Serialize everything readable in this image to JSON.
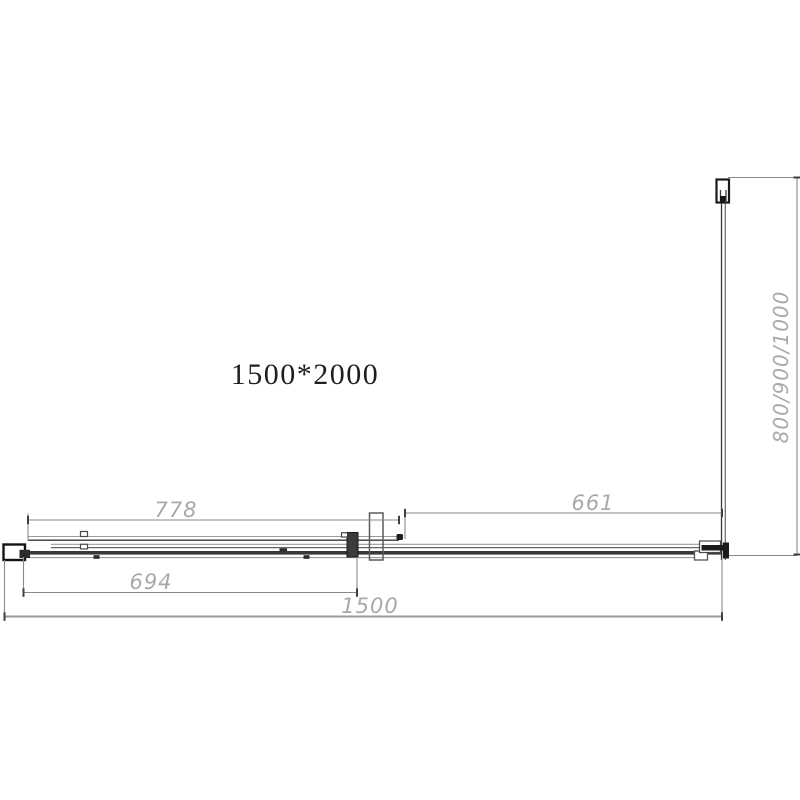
{
  "drawing": {
    "title": "1500*2000",
    "dimensions": {
      "fixed_panel_width": "778",
      "return_panel_width": "661",
      "door_width": "694",
      "total_width": "1500",
      "side_depth_options": "800/900/1000"
    },
    "colors": {
      "line_dark": "#3a3a3a",
      "line_medium": "#666666",
      "line_light": "#9b9b9b",
      "dimension_gray": "#8a8a8a",
      "dimension_text_gray": "#a9a9a9",
      "title_color": "#1f1f1f",
      "background": "#ffffff"
    }
  }
}
